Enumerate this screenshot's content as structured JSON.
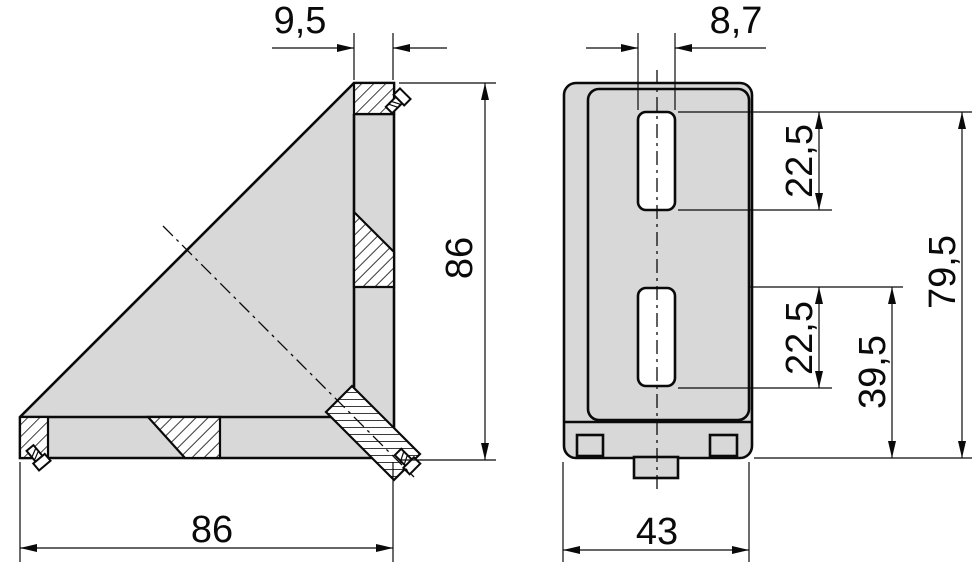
{
  "drawing": {
    "kind": "technical-drawing-two-view-corner-bracket",
    "colors": {
      "part_fill": "#d8d8d8",
      "slot_fill": "#ffffff",
      "line": "#0a0a0a",
      "background": "#ffffff"
    },
    "side_view": {
      "name": "side-view",
      "dimensions": {
        "leg_thickness": "9,5",
        "height": "86",
        "width": "86"
      }
    },
    "front_view": {
      "name": "front-view",
      "dimensions": {
        "slot_width": "8,7",
        "top_slot_length": "22,5",
        "bottom_slot_length": "22,5",
        "top_slot_to_base": "79,5",
        "bottom_slot_to_base": "39,5",
        "width": "43"
      }
    }
  }
}
